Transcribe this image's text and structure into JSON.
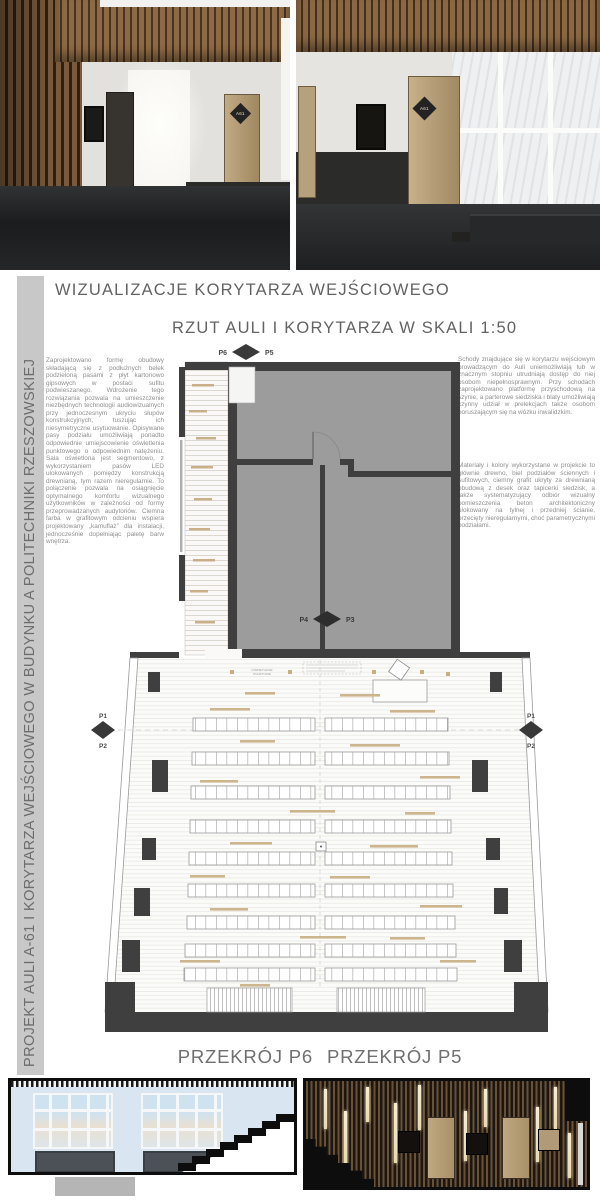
{
  "headings": {
    "visualizations": "WIZUALIZACJE KORYTARZA WEJŚCIOWEGO",
    "plan": "RZUT AULI I KORYTARZA W SKALI 1:50",
    "section_p6": "PRZEKRÓJ P6",
    "section_p5": "PRZEKRÓJ P5"
  },
  "sidebar": {
    "title": "PROJEKT AULI A-61 I KORYTARZA WEJŚCIOWEGO W BUDYNKU A POLITECHNIKI RZESZOWSKIEJ"
  },
  "paragraphs": {
    "left": "Zaprojektowano formę obudowy składającą się z podłużnych belek podzieloną pasami z płyt kartonowo gipsowych w postaci sufitu podwieszanego. Wdrożenie tego rozwiązania pozwala na umieszczenie niezbędnych technologii audiowizualnych przy jednoczesnym ukryciu słupów konstrukcyjnych, tuszując ich niesymetryczne usytuowanie. Opisywane pasy podziału umożliwiają ponadto odpowiednie umiejscowienie oświetlenia punktowego o odpowiednim natężeniu. Sala oświetlona jest segmentowo, z wykorzystaniem pasów LED ulokowanych pomiędzy konstrukcją drewnianą, tym razem nieregularnie. To połączenie pozwala na osiągnięcie optymalnego komfortu wizualnego użytkowników w zależności od formy przeprowadzanych audytoriów. Ciemna farba w grafitowym odcieniu wspiera projektowany „kamuflaż” dla instalacji, jednocześnie dopełniając paletę barw wnętrza.",
    "right_top": "Schody znajdujące się w korytarzu wejściowym prowadzącym do Auli uniemożliwiają lub w znacznym stopniu utrudniają dostęp do niej osobom niepełnosprawnym. Przy schodach zaprojektowano platformę przyschodową na szynie, a parterowe siedziska i blaty umożliwiają czynny udział w prelekcjach także osobom poruszającym się na wózku inwalidzkim.",
    "right_bottom": "Materiały i kolory wykorzystane w projekcie to głównie drewno, biel podziałów ściennych i sufitowych, ciemny grafit ukryty za drewnianą obudową z desek oraz tapicerki siedzisk, a także systematyzujący odbiór wizualny pomieszczenia beton architektoniczny ulokowany na tylnej i przedniej ścianie, przecięty nieregularnymi, choć parametrycznymi podziałami."
  },
  "renders": {
    "left_door_label": "A61",
    "right_door_label": "A61"
  },
  "plan": {
    "markers": {
      "p1": "P1",
      "p2": "P2",
      "p3": "P3",
      "p4": "P4",
      "p5": "P5",
      "p6": "P6"
    },
    "lighting_note_1": "OŚWIETLENIE",
    "lighting_note_2": "PUNKTOWE"
  },
  "colors": {
    "wall_dark": "#3f3f3f",
    "room_gray": "#9c9c9c",
    "accent_beige": "#c9ae82",
    "sidebar_bg": "#c8c8c8",
    "heading_text": "#636363",
    "body_text": "#8e8e8e",
    "wood_dark": "#6a5136",
    "section_sky": "#d9e6f2"
  }
}
